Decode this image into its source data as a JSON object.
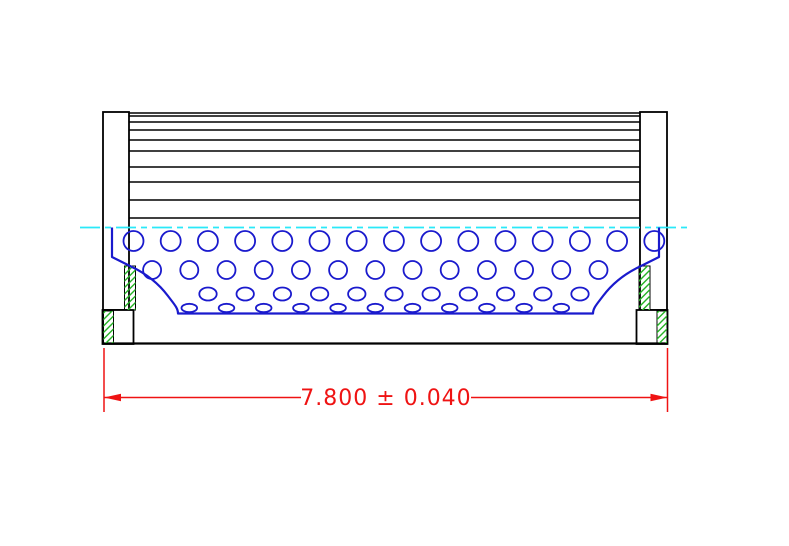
{
  "drawing": {
    "type": "technical-section-view",
    "subject": "pleated filter element with perforated inner core, end caps and overall length dimension",
    "background": "#ffffff",
    "colors": {
      "outline": "#000000",
      "core_blue": "#1a1acd",
      "centerline_cyan": "#2ae9f9",
      "dimension_red": "#ef1313",
      "hatch_green": "#26b426",
      "fill_white": "#ffffff"
    },
    "dimension": {
      "label": "7.800 ± 0.040",
      "value": "7.800",
      "plus_minus": "±",
      "tolerance": "0.040",
      "text_x": 386,
      "text_y": 405,
      "font_size": 22,
      "line_y": 397.5,
      "segments": [
        [
          104,
          301
        ],
        [
          471,
          667.5
        ]
      ],
      "ext_lines_x": [
        104,
        667.5
      ],
      "ext_line_y1": 348,
      "ext_line_y2": 412,
      "arrow_len": 17,
      "arrow_half_w": 3.8
    },
    "centerline": {
      "x1": 80,
      "x2": 688,
      "y": 227.5,
      "dash": "20 5 6 5",
      "width": 1.8
    },
    "pleats": {
      "x1": 129,
      "x2": 640,
      "line_ys": [
        113,
        116,
        122,
        130,
        140,
        151,
        167,
        182,
        200,
        218
      ],
      "width": 1.6
    },
    "end_caps": {
      "rects": [
        {
          "name": "left-cap",
          "x": 103,
          "y": 112,
          "w": 26,
          "h": 198
        },
        {
          "name": "right-cap",
          "x": 640,
          "y": 112,
          "w": 27,
          "h": 198
        },
        {
          "name": "left-step-box",
          "x": 102.5,
          "y": 310,
          "w": 31,
          "h": 34
        },
        {
          "name": "right-step-box",
          "x": 636.5,
          "y": 310,
          "w": 31,
          "h": 34
        }
      ],
      "baseline": {
        "x1": 103,
        "x2": 667,
        "y": 343.5,
        "width": 2.2
      },
      "stroke_width": 1.8
    },
    "hatch": {
      "spacing": 6.5,
      "stroke_width": 1.4,
      "rects": [
        {
          "x": 124.5,
          "y": 266,
          "w": 11,
          "h": 44
        },
        {
          "x": 639,
          "y": 266,
          "w": 11,
          "h": 44
        },
        {
          "x": 103.5,
          "y": 311,
          "w": 10,
          "h": 32
        },
        {
          "x": 657,
          "y": 311,
          "w": 10,
          "h": 32
        }
      ]
    },
    "perforated_core": {
      "outline_path": "M 112 227.5 L 112 257 L 131 266.5 C 147 274 159 284 168 296 C 174 304 178 308 178 313.5 L 593 313.5 C 593 308 597 304 603 296 C 612 284 624 274 640 266.5 L 659 257 L 659 227.5",
      "outline_width": 2.2,
      "hole_stroke_width": 1.8,
      "hole_rows": [
        {
          "y": 241,
          "rx": 10,
          "ry": 10,
          "start_x": 133.5,
          "step": 37.2,
          "count": 15
        },
        {
          "y": 270,
          "rx": 9,
          "ry": 9,
          "start_x": 152.1,
          "step": 37.2,
          "count": 13
        },
        {
          "y": 294,
          "rx": 8.7,
          "ry": 6.5,
          "start_x": 208.0,
          "step": 37.2,
          "count": 11
        },
        {
          "y": 308,
          "rx": 7.8,
          "ry": 4.2,
          "start_x": 189.3,
          "step": 37.2,
          "count": 11
        }
      ]
    }
  }
}
